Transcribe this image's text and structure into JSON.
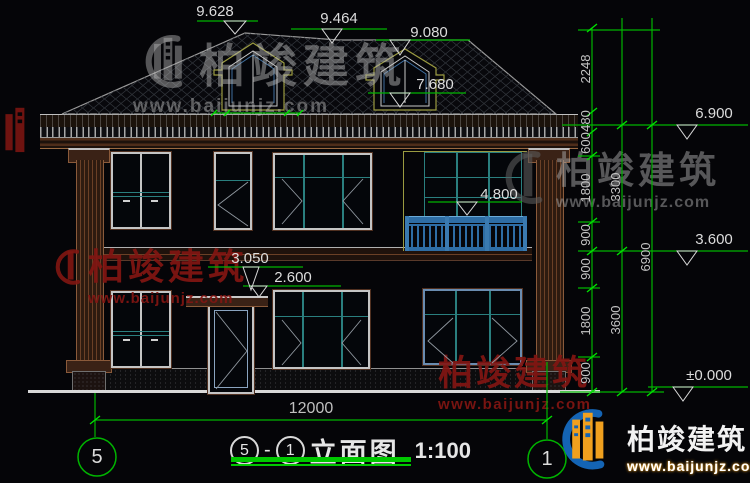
{
  "drawing": {
    "title": {
      "bubble_left": "5",
      "separator": "-",
      "bubble_right": "1",
      "name": "立面图",
      "scale": "1:100"
    },
    "grid_bubbles": {
      "left": "5",
      "right": "1"
    }
  },
  "levels": {
    "ridge": "9.628",
    "ridge2": "9.464",
    "ridge3": "9.080",
    "dormer": "7.680",
    "eave": "6.900",
    "balcony": "4.800",
    "floor2": "3.600",
    "canopy_top": "3.050",
    "canopy": "2.600",
    "ground": "±0.000"
  },
  "dims": {
    "chain1": [
      "2248",
      "480",
      "600",
      "1800",
      "900",
      "900",
      "1800",
      "900"
    ],
    "chain2": [
      "3300",
      "3600"
    ],
    "chain3": [
      "6900"
    ],
    "total_width": "12000"
  },
  "watermark": {
    "brand": "柏竣建筑",
    "url": "www.baijunjz.com"
  },
  "colors": {
    "dim_green": "#00b400",
    "window_teal": "#2a7f7f",
    "railing_blue": "#2e6da4",
    "trim_brown": "#5a3a2a",
    "accent_olive": "#9a9a40",
    "watermark_red": "#7a1614",
    "logo_blue": "#1464b4",
    "logo_orange": "#f0a01e",
    "line_white": "#d8d8d8"
  }
}
